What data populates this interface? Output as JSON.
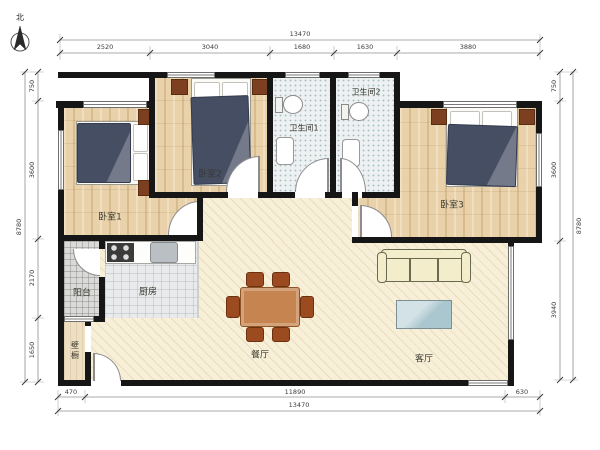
{
  "north": {
    "label": "北"
  },
  "rooms": {
    "bedroom1": "卧室1",
    "bedroom2": "卧室2",
    "bedroom3": "卧室3",
    "bath1": "卫生间1",
    "bath2": "卫生间2",
    "kitchen": "厨房",
    "balcony": "阳台",
    "closet": "壁橱",
    "dining": "餐厅",
    "living": "客厅"
  },
  "dimensions": {
    "top_total": "13470",
    "top_segments": [
      "2520",
      "3040",
      "1680",
      "1630",
      "3880"
    ],
    "left_total": "8780",
    "left_segments": [
      "750",
      "3600",
      "2170",
      "1650"
    ],
    "right_total": "8780",
    "right_segments": [
      "750",
      "3600",
      "3940"
    ],
    "bottom_total": "13470",
    "bottom_segments": [
      "470",
      "11890",
      "630"
    ]
  },
  "palette": {
    "wall": "#161616",
    "wood_floor": "#e9d2a9",
    "living_floor": "#f7efd7",
    "bath_tile": "#edf1f2",
    "duvet": "#454e63",
    "nightstand": "#7c3f20",
    "sofa": "#f3edcb",
    "dining_table": "#c58450",
    "coffee_table": "#b9d3d9"
  }
}
